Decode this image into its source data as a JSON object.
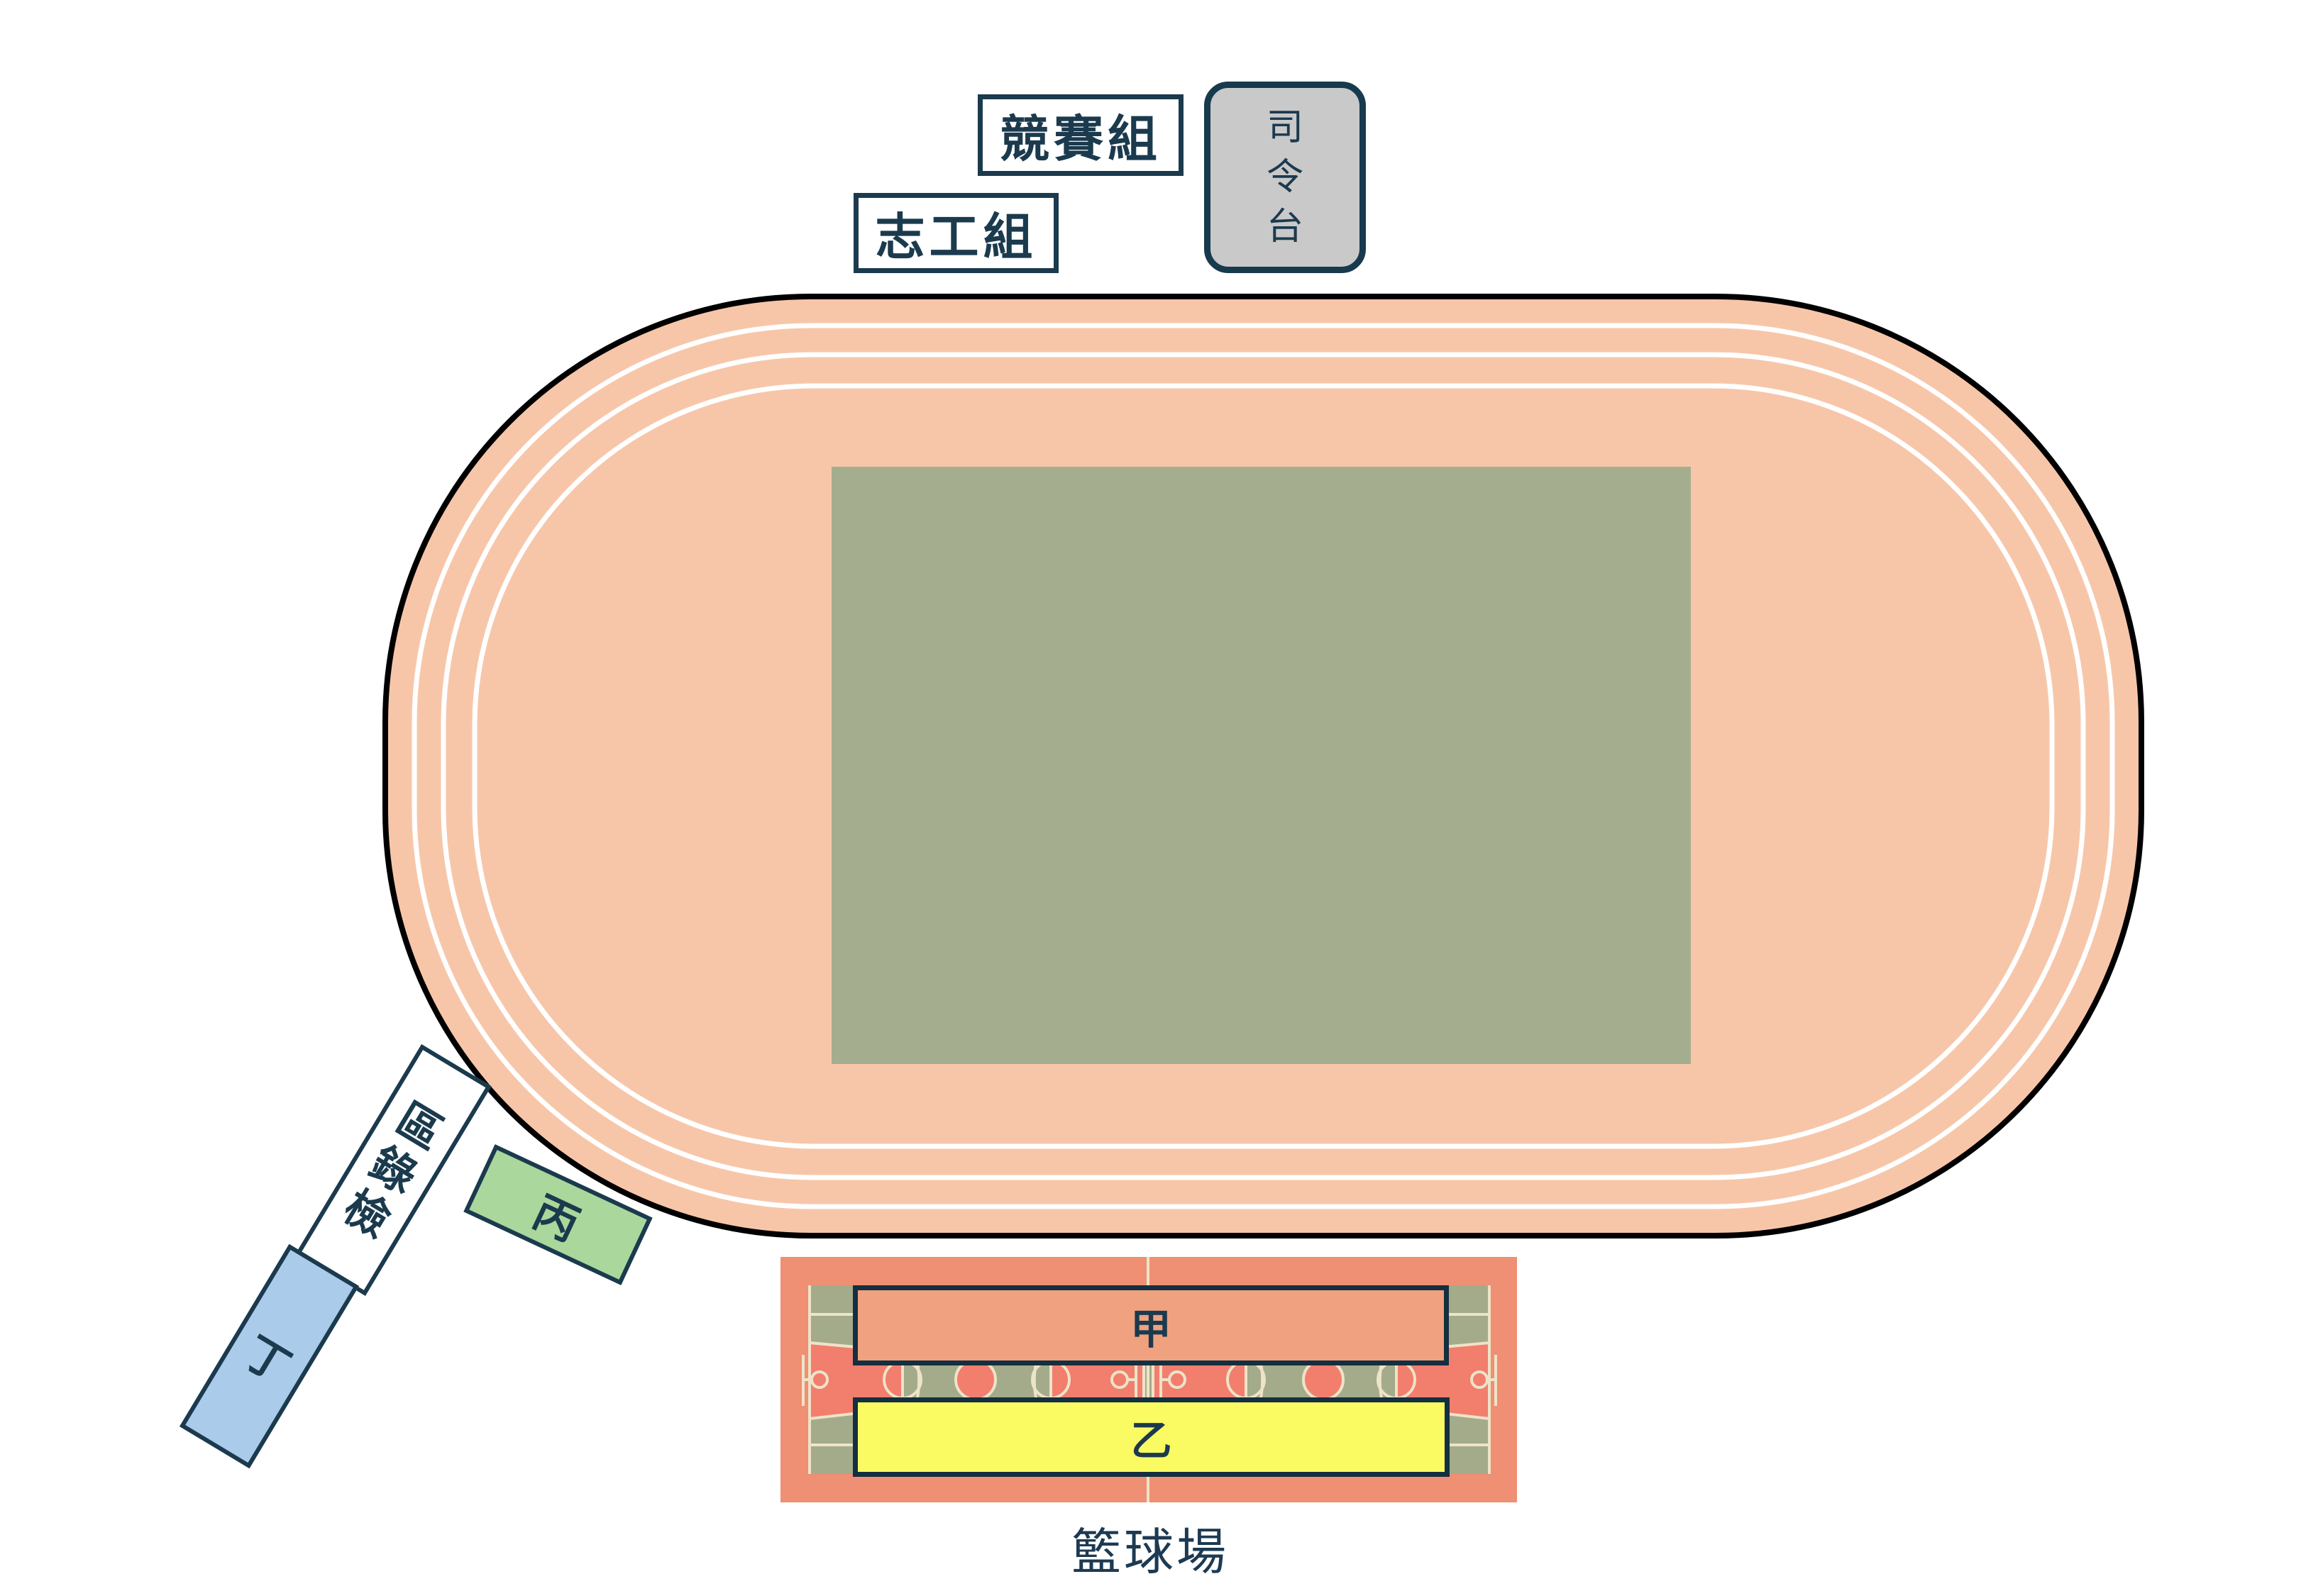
{
  "palette": {
    "navy_border": "#1b3a4e",
    "track_outline": "#000000",
    "track_salmon": "#f7c6a9",
    "lane_line_white": "#ffffff",
    "infield_green": "#a5ad8f",
    "court_red": "#ef8f73",
    "court_green": "#a3ab8b",
    "court_line_cream": "#eee3c8",
    "court_key_salmon": "#f27e6d",
    "podium_gray": "#c9c9c9",
    "zone_jia_orange": "#f0a17f",
    "zone_yi_yellow": "#fafb63",
    "zone_bing_green": "#aad79b",
    "zone_ding_blue": "#abcbea"
  },
  "labels": {
    "competition_group": "競賽組",
    "volunteer_group": "志工組",
    "command_platform": "司令台",
    "check_in_area": "檢錄區",
    "zone_bing": "丙",
    "zone_ding": "丁",
    "zone_jia": "甲",
    "zone_yi": "乙",
    "basketball_court_caption": "籃球場"
  }
}
